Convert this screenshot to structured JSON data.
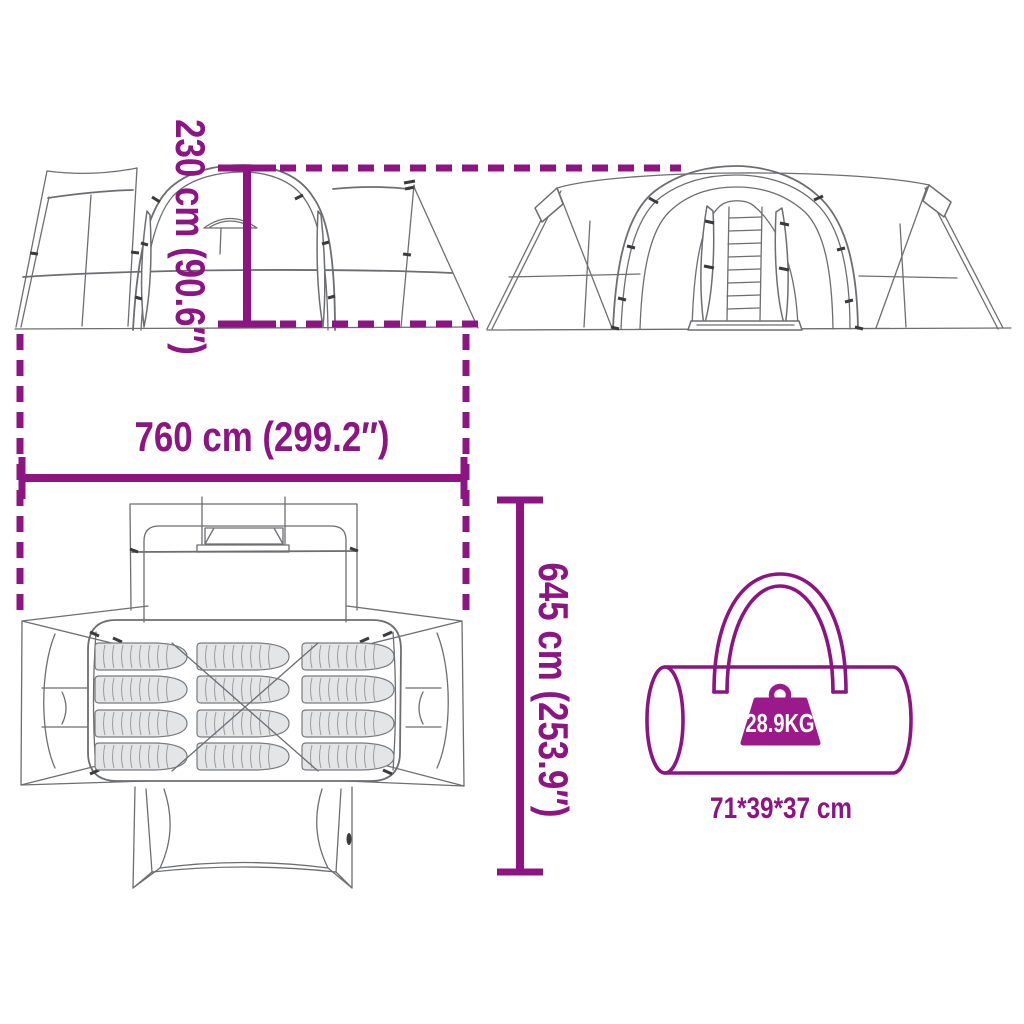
{
  "labels": {
    "height": "230 cm (90.6″)",
    "width": "760 cm (299.2″)",
    "depth": "645 cm (253.9″)",
    "bag_size": "71*39*37 cm",
    "bag_weight": "28.9KG"
  },
  "colors": {
    "accent": "#8C1483",
    "badge": "#9A1A8C",
    "line_art": "#6D6E71",
    "mat_fill": "#E4E5E6"
  },
  "icons": {
    "side_view": "tent-side-view-drawing",
    "front_view": "tent-front-view-drawing",
    "floor_plan": "tent-floor-plan-drawing",
    "bag": "carry-bag-icon",
    "weight": "weight-icon"
  }
}
